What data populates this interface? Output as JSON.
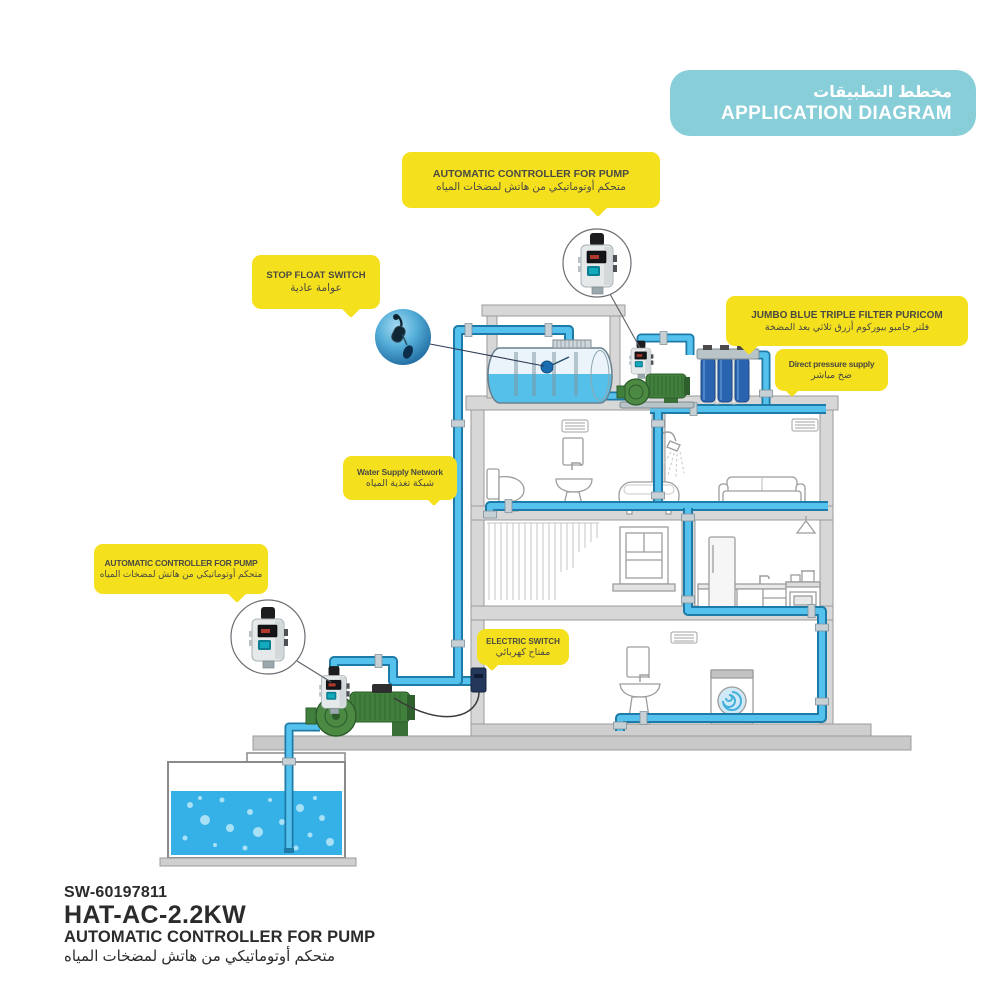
{
  "banner": {
    "title_ar": "مخطط التطبيقات",
    "title_en": "APPLICATION DIAGRAM"
  },
  "callouts": {
    "roof_controller": {
      "en": "AUTOMATIC CONTROLLER FOR PUMP",
      "ar": "متحكم أوتوماتيكي من هاتش لمضخات المياه"
    },
    "stop_float_switch": {
      "en": "STOP FLOAT SWITCH",
      "ar": "عوامة عادية"
    },
    "jumbo_filter": {
      "en": "JUMBO BLUE TRIPLE FILTER PURICOM",
      "ar": "فلتر جامبو بيوركوم أزرق ثلاثي بعد المضخة"
    },
    "direct_pressure": {
      "en": "Direct pressure supply",
      "ar": "ضخ مباشر"
    },
    "water_network": {
      "en": "Water Supply Network",
      "ar": "شبكة تغذية المياه"
    },
    "ground_controller": {
      "en": "AUTOMATIC CONTROLLER FOR PUMP",
      "ar": "متحكم أوتوماتيكي من هاتش لمضخات المياه"
    },
    "electric_switch": {
      "en": "ELECTRIC SWITCH",
      "ar": "مفتاح كهربائي"
    }
  },
  "product": {
    "sku": "SW-60197811",
    "model": "HAT-AC-2.2KW",
    "name_en": "AUTOMATIC CONTROLLER FOR PUMP",
    "name_ar": "متحكم أوتوماتيكي من هاتش لمضخات المياه"
  },
  "colors": {
    "teal": "#87ced9",
    "yellow": "#f5e01e",
    "pipe_blue": "#55c2ee",
    "pipe_edge": "#1e7aa6",
    "water_blue": "#35b1e8",
    "pump_green": "#417f3c",
    "filter_blue": "#2a64b0",
    "wall_gray": "#d7d7d7"
  }
}
